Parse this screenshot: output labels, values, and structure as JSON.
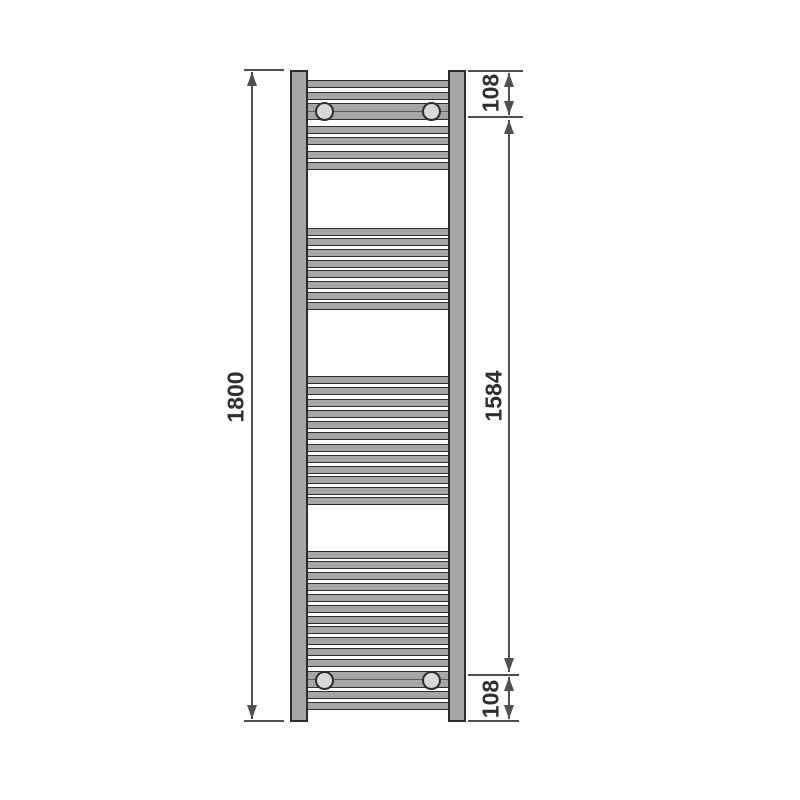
{
  "diagram": {
    "type": "technical-dimension-drawing",
    "subject": "ladder towel radiator, front elevation",
    "units": "mm"
  },
  "colors": {
    "background": "#ffffff",
    "metal_fill": "#a6a6a6",
    "outline": "#2d2d2d",
    "bracket_fill": "#d9d9d9",
    "dimension_line": "#4f4f4f",
    "dimension_text": "#2e2e2e"
  },
  "radiator": {
    "tubes": {
      "top": 70,
      "bottom": 722,
      "left_x": 290,
      "right_x": 448,
      "width": 18
    },
    "rung_span": {
      "left": 306,
      "right": 450
    },
    "rung_h": 7.5,
    "band_h": 17,
    "bracket_d": 19,
    "rungs": [
      {
        "y": 80
      },
      {
        "y": 92
      },
      {
        "y": 103,
        "band": true
      },
      {
        "y": 126
      },
      {
        "y": 137
      },
      {
        "y": 151
      },
      {
        "y": 162
      },
      {
        "y": 228
      },
      {
        "y": 238
      },
      {
        "y": 249
      },
      {
        "y": 260
      },
      {
        "y": 270
      },
      {
        "y": 281
      },
      {
        "y": 292
      },
      {
        "y": 302
      },
      {
        "y": 376
      },
      {
        "y": 387
      },
      {
        "y": 399
      },
      {
        "y": 410
      },
      {
        "y": 421
      },
      {
        "y": 432
      },
      {
        "y": 444
      },
      {
        "y": 455
      },
      {
        "y": 466
      },
      {
        "y": 476
      },
      {
        "y": 487
      },
      {
        "y": 497
      },
      {
        "y": 551
      },
      {
        "y": 561
      },
      {
        "y": 572
      },
      {
        "y": 583
      },
      {
        "y": 594
      },
      {
        "y": 605
      },
      {
        "y": 616
      },
      {
        "y": 626
      },
      {
        "y": 637
      },
      {
        "y": 648
      },
      {
        "y": 659
      },
      {
        "y": 671,
        "band": true
      },
      {
        "y": 691
      },
      {
        "y": 702
      }
    ],
    "brackets": [
      {
        "cx": 324,
        "cy": 111
      },
      {
        "cx": 431,
        "cy": 111
      },
      {
        "cx": 324,
        "cy": 680
      },
      {
        "cx": 431,
        "cy": 680
      }
    ]
  },
  "dimensions": [
    {
      "id": "overall-height",
      "label": "1800",
      "value_mm": 1800,
      "x": 252,
      "y1": 72,
      "y2": 719,
      "label_x": 236,
      "label_y": 397,
      "ext": [
        {
          "y": 70,
          "x1": 244,
          "x2": 284
        },
        {
          "y": 721,
          "x1": 244,
          "x2": 284
        }
      ]
    },
    {
      "id": "top-bracket-offset",
      "label": "108",
      "value_mm": 108,
      "x": 509,
      "y1": 73,
      "y2": 115,
      "label_x": 491,
      "label_y": 93,
      "ext": [
        {
          "y": 71,
          "x1": 468,
          "x2": 523
        },
        {
          "y": 117,
          "x1": 468,
          "x2": 523
        }
      ]
    },
    {
      "id": "bracket-centres-height",
      "label": "1584",
      "value_mm": 1584,
      "x": 509,
      "y1": 120,
      "y2": 672,
      "label_x": 494,
      "label_y": 396,
      "ext": []
    },
    {
      "id": "bottom-bracket-offset",
      "label": "108",
      "value_mm": 108,
      "x": 509,
      "y1": 677,
      "y2": 719,
      "label_x": 491,
      "label_y": 699,
      "ext": [
        {
          "y": 675,
          "x1": 468,
          "x2": 519
        },
        {
          "y": 721,
          "x1": 468,
          "x2": 519
        }
      ]
    }
  ]
}
